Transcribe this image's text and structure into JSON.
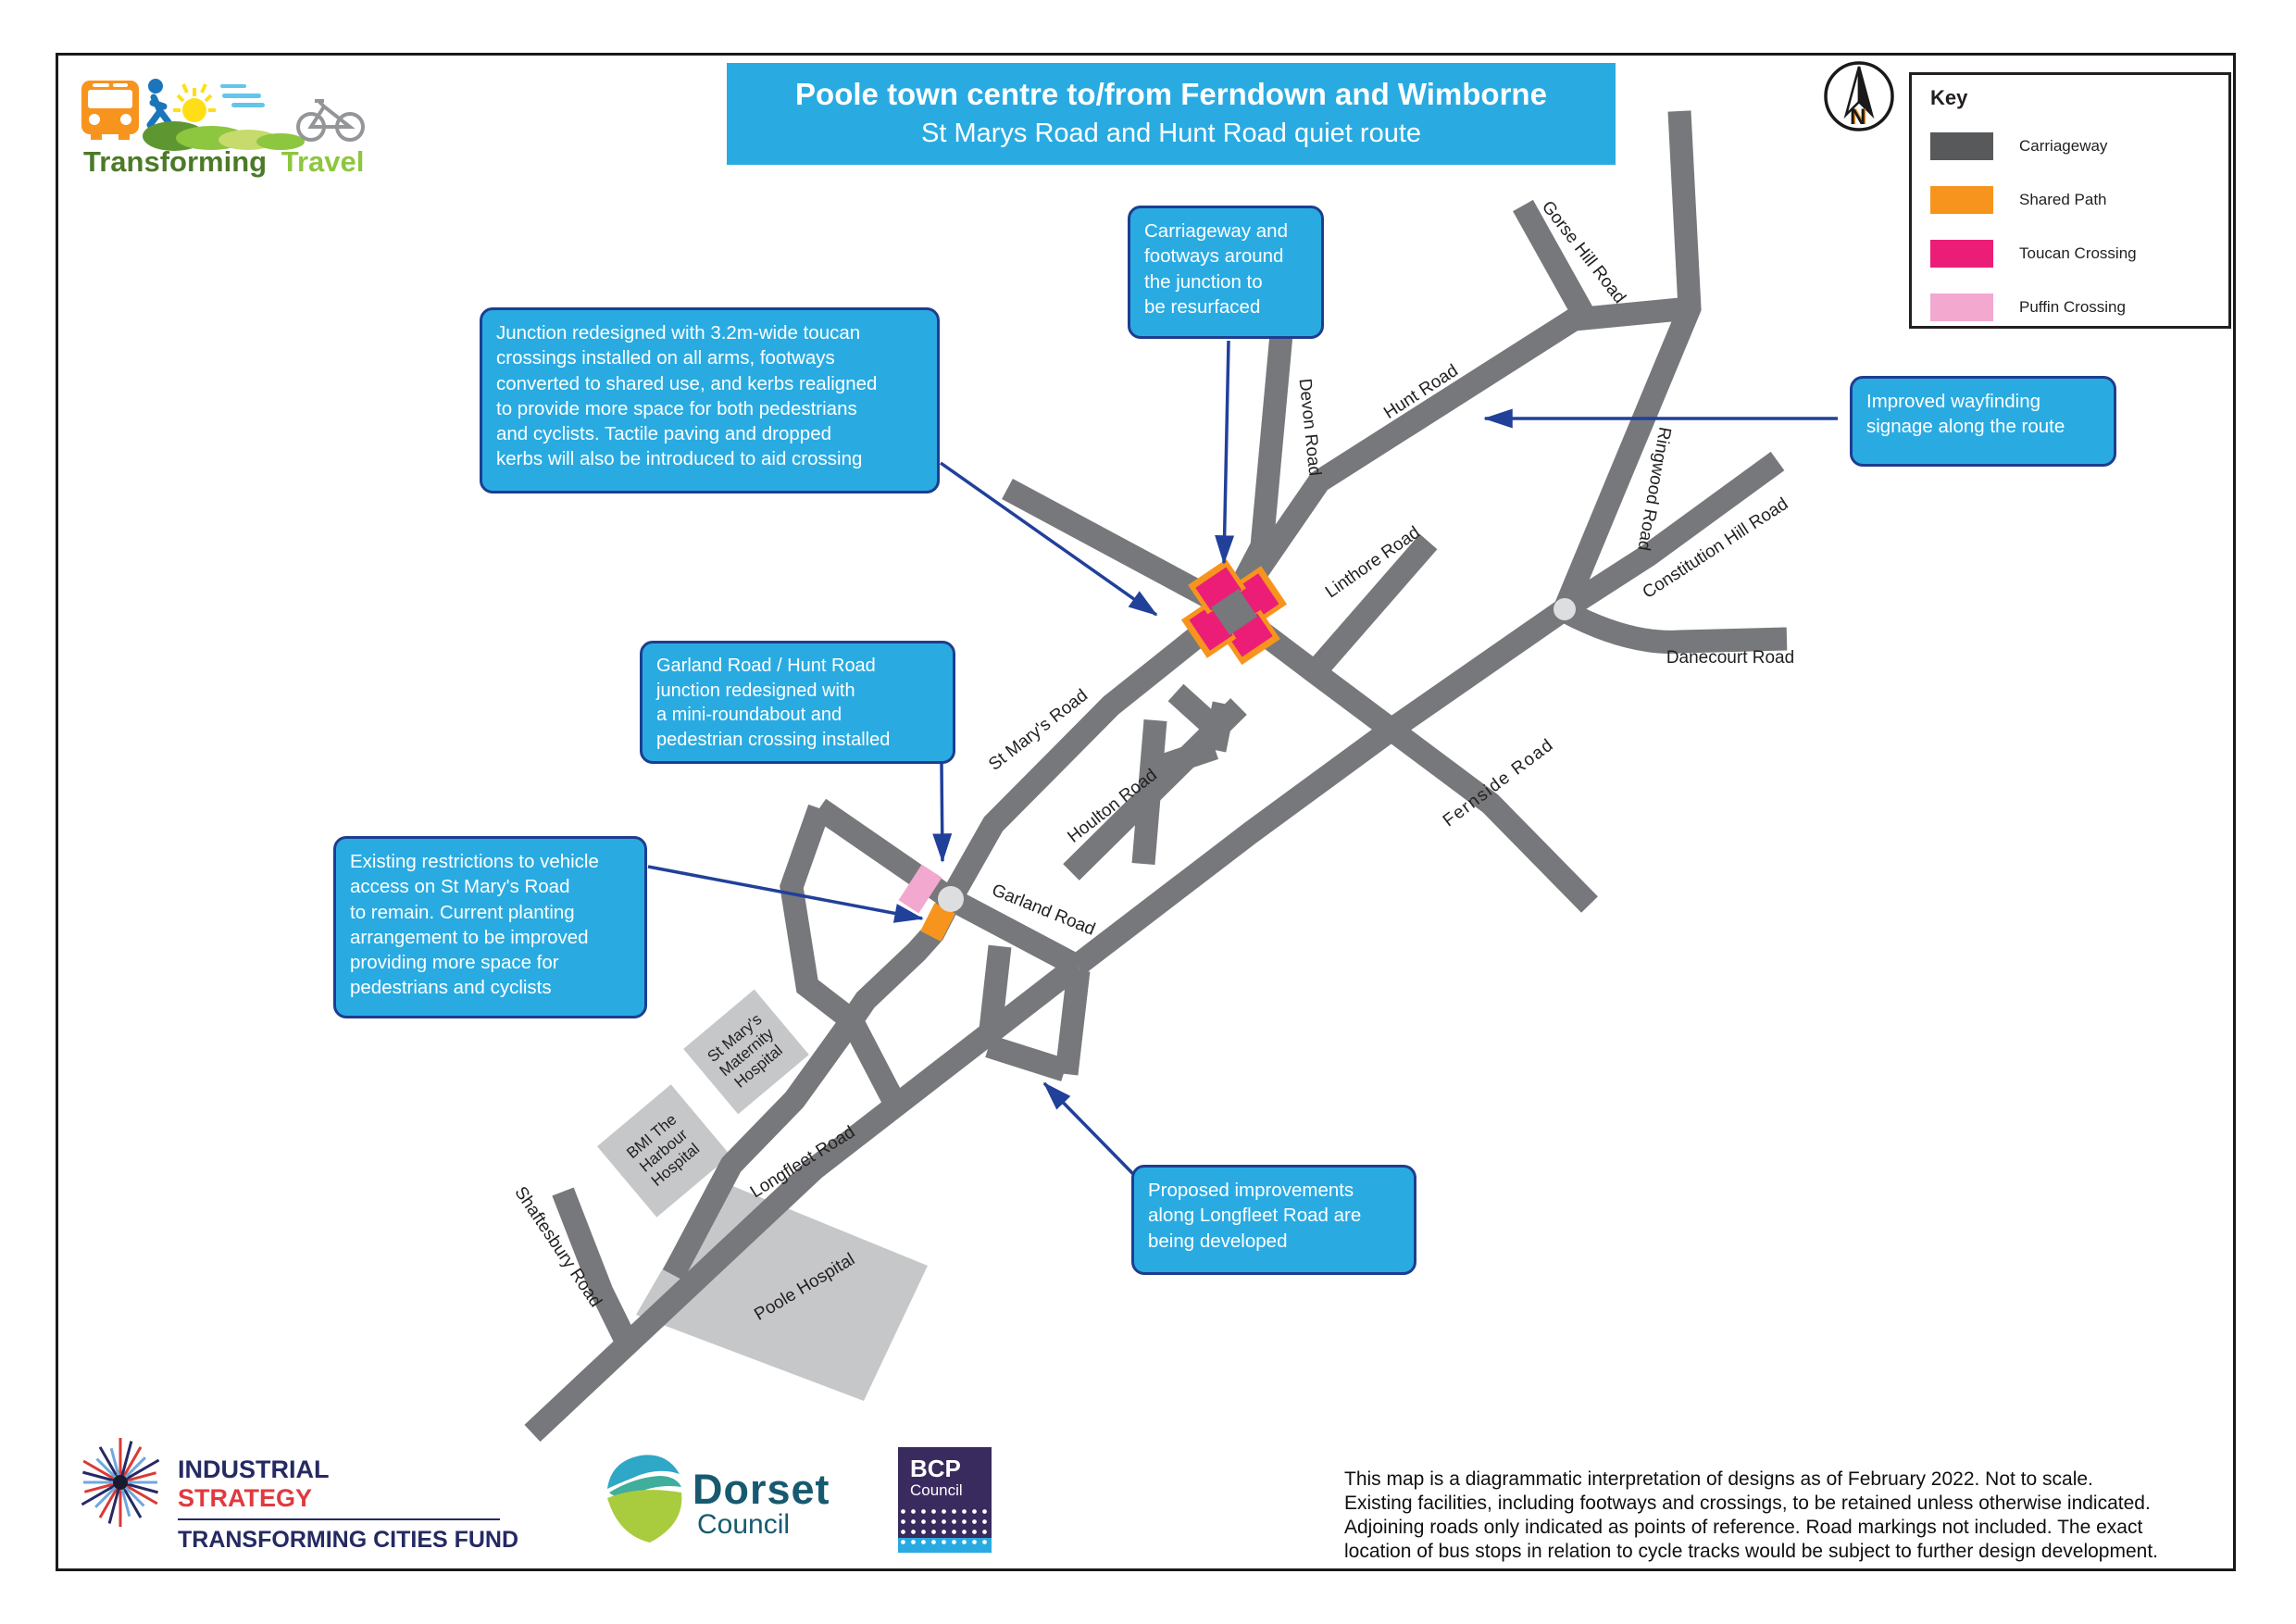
{
  "branding": {
    "logo_primary": "Transforming",
    "logo_secondary": "Travel"
  },
  "title": {
    "line1": "Poole town centre to/from Ferndown and Wimborne",
    "line2": "St Marys Road and Hunt Road quiet route"
  },
  "compass": {
    "label": "N"
  },
  "key": {
    "title": "Key",
    "items": [
      {
        "label": "Carriageway",
        "color": "#58595B"
      },
      {
        "label": "Shared Path",
        "color": "#F7941E"
      },
      {
        "label": "Toucan Crossing",
        "color": "#EC1D77"
      },
      {
        "label": "Puffin Crossing",
        "color": "#F2A8CF"
      }
    ]
  },
  "callouts": {
    "junction_redesigned": "Junction redesigned with 3.2m-wide toucan\ncrossings installed on all arms, footways\nconverted to shared use, and kerbs realigned\nto provide more space for both pedestrians\nand cyclists. Tactile paving and dropped\nkerbs will also be introduced to aid crossing",
    "resurfaced": "Carriageway and\nfootways around\nthe junction to\nbe resurfaced",
    "wayfinding": "Improved wayfinding\nsignage along the route",
    "garland_junction": "Garland Road / Hunt Road\njunction redesigned with\na mini-roundabout and\npedestrian crossing installed",
    "existing_restrictions": "Existing restrictions to vehicle\naccess on St Mary's Road\nto remain. Current planting\narrangement to be improved\nproviding more space for\npedestrians and cyclists",
    "longfleet_improvements": "Proposed improvements\nalong Longfleet Road are\nbeing developed"
  },
  "roads": {
    "hunt": "Hunt Road",
    "gorse": "Gorse Hill Road",
    "devon": "Devon Road",
    "ringwood": "Ringwood Road",
    "constitution": "Constitution Hill Road",
    "danecourt": "Danecourt Road",
    "linthore": "Linthore Road",
    "fernside": "Fernside Road",
    "st_marys": "St Mary's Road",
    "houlton": "Houlton Road",
    "garland": "Garland Road",
    "longfleet": "Longfleet Road",
    "shaftesbury": "Shaftesbury Road"
  },
  "buildings": {
    "bmi": {
      "lines": [
        "BMI The",
        "Harbour",
        "Hospital"
      ]
    },
    "maternity": {
      "lines": [
        "St Mary's",
        "Maternity",
        "Hospital"
      ]
    },
    "poole": {
      "label": "Poole Hospital"
    }
  },
  "footer": {
    "industrial": {
      "line1": "INDUSTRIAL",
      "line2": "STRATEGY",
      "line3": "TRANSFORMING CITIES FUND"
    },
    "dorset": {
      "name": "Dorset",
      "sub": "Council"
    },
    "bcp": {
      "name": "BCP",
      "sub": "Council"
    },
    "disclaimer": "This map is a diagrammatic interpretation of designs as of February 2022. Not to scale.\nExisting facilities, including footways and crossings, to be retained unless otherwise indicated.\nAdjoining roads only indicated as points of reference. Road markings not included. The exact\nlocation of bus stops in relation to cycle tracks would be subject to further design development.",
    "colors": {
      "industrial_navy": "#252A63",
      "industrial_red": "#E03A3E",
      "bcp_purple": "#3A2B5F",
      "dorset_teal": "#175A70"
    }
  },
  "map_colors": {
    "carriageway": "#77787B",
    "building": "#C6C7C9",
    "toucan": "#EC1D77",
    "shared_path": "#F7941E",
    "puffin": "#F2A8CF",
    "callout_blue": "#29ABE2",
    "callout_border": "#1E3D8F",
    "arrow_navy": "#21409A"
  }
}
